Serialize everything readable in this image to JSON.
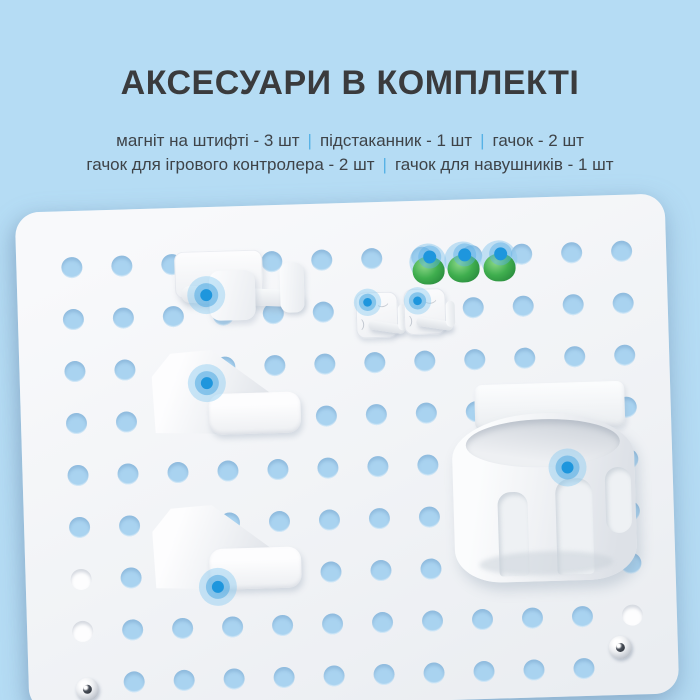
{
  "header": {
    "title": "АКСЕСУАРИ В КОМПЛЕКТІ"
  },
  "accessories": {
    "separator": "|",
    "line1": [
      "магніт на штифті - 3 шт",
      "підстаканник - 1 шт",
      "гачок - 2 шт"
    ],
    "line2": [
      "гачок для ігрового контролера - 2 шт",
      "гачок для навушників - 1 шт"
    ]
  },
  "colors": {
    "background": "#b5dcf4",
    "hole_blue": "#a9d3f0",
    "hole_white": "#fdfdfe",
    "hotspot_blue": "#1e96dd",
    "magnet_green": "#3fae4e",
    "separator_blue": "#56b2e6",
    "title_text": "#3a3b3d",
    "body_text": "#3e4348"
  }
}
